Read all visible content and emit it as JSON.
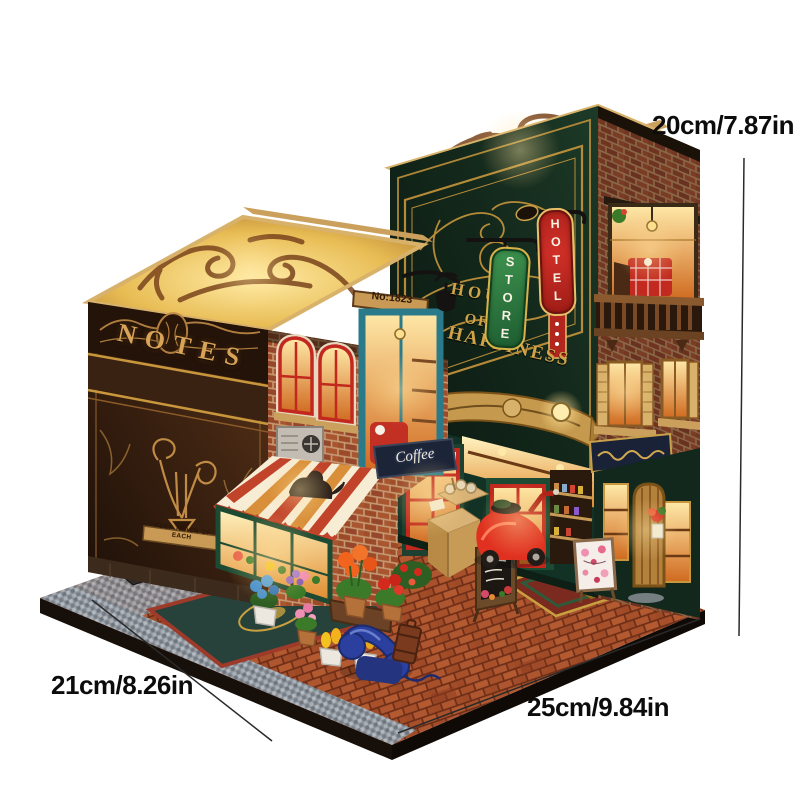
{
  "annotations": {
    "height_label": "20cm/7.87in",
    "depth_label": "21cm/8.26in",
    "width_label": "25cm/9.84in"
  },
  "model": {
    "left_book": {
      "spine_title": "NOTES",
      "spine_plaque": "KEEP TRACK OF EACH",
      "door_number_sign": "No:1823",
      "coffee_sign": "Coffee"
    },
    "right_book": {
      "facade_word1": "HOUSE",
      "facade_word2": "OF",
      "facade_word3": "HAPPINESS",
      "hotel_sign": "HOTEL",
      "store_sign": "STORE"
    }
  },
  "colors": {
    "background": "#ffffff",
    "annotation_text": "#0c0c0c",
    "book_cover_brown": "#3a2414",
    "book_cover_green": "#0f2018",
    "gold_accent": "#d8a258",
    "awning_red": "#c1432a",
    "awning_cream": "#f7ecd4",
    "hotel_sign_red": "#b3261e",
    "store_sign_green": "#2e7d44",
    "brick_red": "#9c4a28",
    "warm_light": "#ffd886",
    "scooter_red": "#e03020",
    "telephone_blue": "#2b3f9e",
    "teal_door": "#2a7a8a"
  }
}
